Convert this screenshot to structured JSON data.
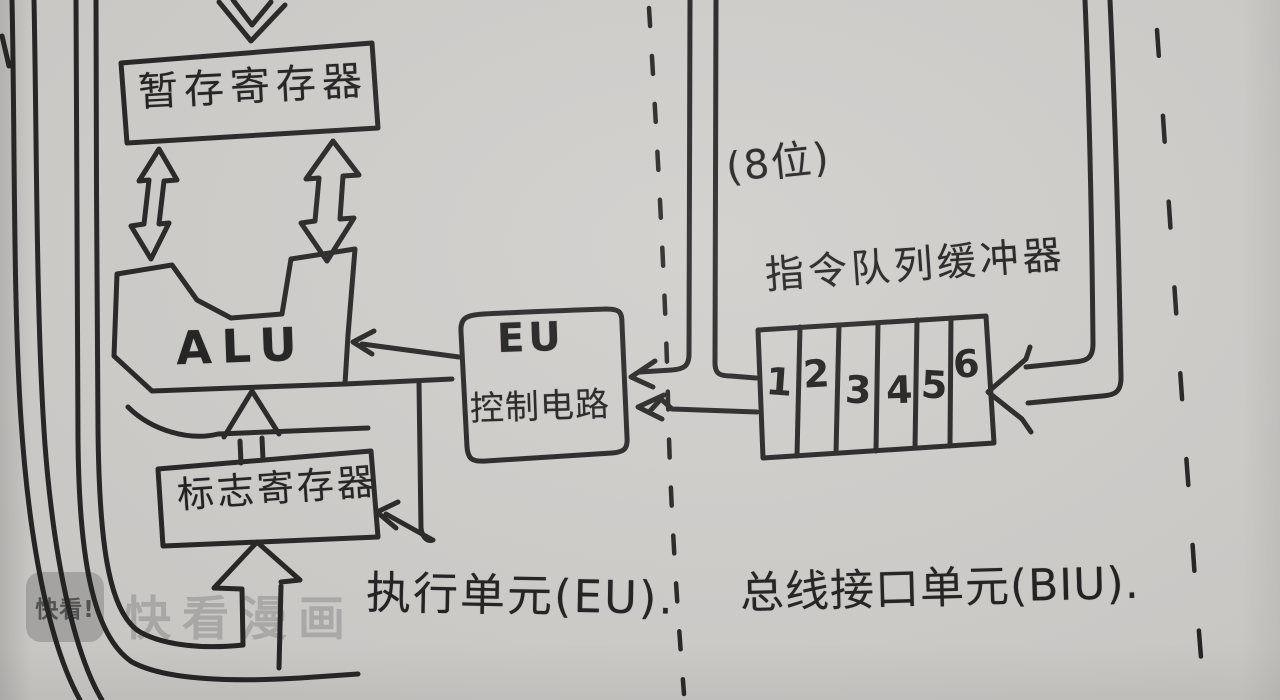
{
  "colors": {
    "paper": "#cfcdca",
    "ink": "#242424",
    "watermark_gray": "#969696"
  },
  "diagram": {
    "temp_register": {
      "label": "暂存寄存器"
    },
    "alu": {
      "label": "ALU"
    },
    "flag_register": {
      "label": "标志寄存器"
    },
    "eu_control": {
      "line1": "EU",
      "line2": "控制电路"
    },
    "queue": {
      "label": "指令队列缓冲器",
      "cells": [
        "1",
        "2",
        "3",
        "4",
        "5",
        "6"
      ]
    },
    "bits_note": "(8位)",
    "captions": {
      "eu": "执行单元(EU).",
      "biu": "总线接口单元(BIU)."
    }
  },
  "watermark": {
    "logo_text": "快看!",
    "text": "快看漫画"
  }
}
